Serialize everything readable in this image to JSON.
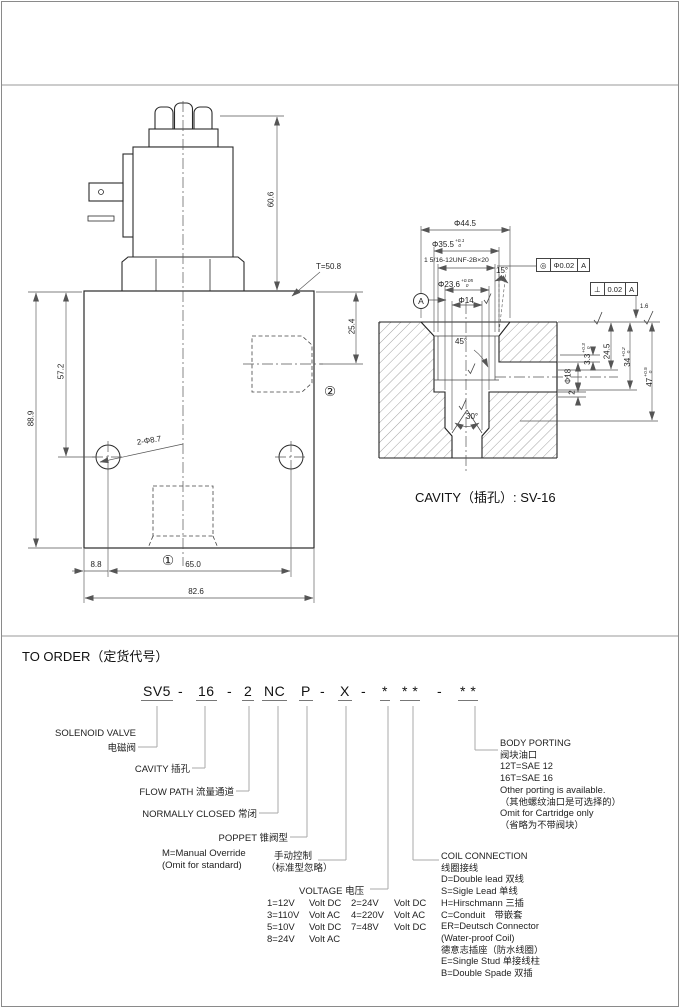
{
  "captions": {
    "cavity": "CAVITY（插孔）: SV-16",
    "to_order": "TO ORDER（定货代号）"
  },
  "valve": {
    "dim_coil_height": "60.6",
    "dim_torque": "T=50.8",
    "dim_port_depth": "25.4",
    "dim_body_height": "88.9",
    "dim_hole_offset": "57.2",
    "dim_holes": "2-Φ8.7",
    "dim_edge": "8.8",
    "dim_hole_span": "65.0",
    "dim_body_width": "82.6",
    "port1": "①",
    "port2": "②"
  },
  "cavity": {
    "dim_d44": "Φ44.5",
    "dim_d35": {
      "base": "Φ35.5",
      "sup": "+0.1",
      "sub": "0"
    },
    "thread": "1 5/16-12UNF-2B×20",
    "dim_d23": {
      "base": "Φ23.6",
      "sup": "+0.05",
      "sub": "0"
    },
    "dim_d14": "Φ14",
    "ang15": "15°",
    "ang45": "45°",
    "ang30": "30°",
    "dim_d18": "Φ18",
    "dim_2": "2",
    "dim_3_3": {
      "base": "3.3",
      "sup": "+0.3",
      "sub": "0"
    },
    "dim_24_5": "24.5",
    "dim_34": {
      "base": "34",
      "sup": "+0.2",
      "sub": "0"
    },
    "dim_47": {
      "base": "47",
      "sup": "+0.5",
      "sub": "0"
    },
    "fcf_concentricity": {
      "sym": "◎",
      "tol": "Φ0.02",
      "datum": "A"
    },
    "fcf_perpendicularity": {
      "sym": "⊥",
      "tol": "0.02",
      "datum": "A"
    },
    "datum": "A",
    "finish": "1.6"
  },
  "order": {
    "tokens": [
      "SV5",
      "-",
      "16",
      "-",
      "2",
      "NC",
      "P",
      "-",
      "X",
      "-",
      "*",
      "* *",
      "-",
      "* *"
    ],
    "labels": {
      "solenoid_en": "SOLENOID VALVE",
      "solenoid_cn": "电磁阀",
      "cavity": "CAVITY  插孔",
      "flow_path": "FLOW PATH  流量通道",
      "normally_closed": "NORMALLY CLOSED  常闭",
      "poppet": "POPPET  锥阀型",
      "manual_1": "M=Manual Override",
      "manual_2": "(Omit for standard)",
      "manual_cn1": "手动控制",
      "manual_cn2": "（标准型忽略）"
    },
    "voltage": {
      "title": "VOLTAGE  电压",
      "rows": [
        [
          "1=12V",
          "Volt DC",
          "2=24V",
          "Volt DC"
        ],
        [
          "3=110V",
          "Volt AC",
          "4=220V",
          "Volt AC"
        ],
        [
          "5=10V",
          "Volt DC",
          "7=48V",
          "Volt DC"
        ],
        [
          "8=24V",
          "Volt AC",
          "",
          ""
        ]
      ]
    },
    "coil": {
      "lines": [
        "COIL CONNECTION",
        "线圈接线",
        "D=Double lead 双线",
        "S=Sigle Lead  单线",
        "H=Hirschmann  三插",
        "C=Conduit　带嵌套",
        "ER=Deutsch Connector",
        "(Water-proof Coil)",
        "德意志插座（防水线圈）",
        "E=Single Stud  单接线柱",
        "B=Double Spade  双插"
      ]
    },
    "body_porting": {
      "lines": [
        "BODY PORTING",
        "阀块油口",
        "12T=SAE 12",
        "16T=SAE 16",
        "Other porting is available.",
        "（其他螺纹油口是可选择的）",
        "Omit for Cartridge only",
        "（省略为不带阀块）"
      ]
    }
  }
}
